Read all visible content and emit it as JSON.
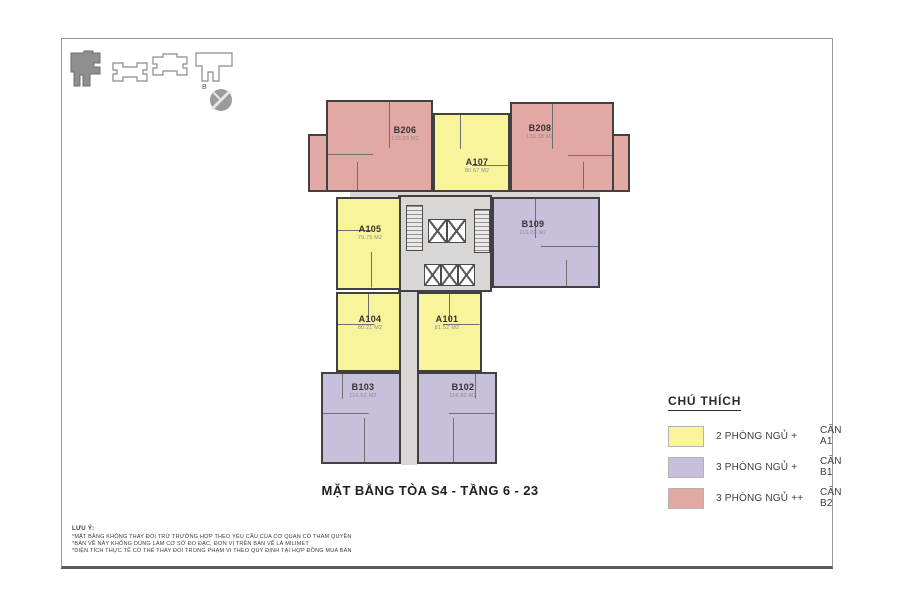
{
  "title": "MẶT BẰNG TÒA S4 - TẦNG 6 - 23",
  "keyplan": {
    "north_label": "B"
  },
  "colors": {
    "a1": "#f8f49c",
    "b1": "#c8bfdc",
    "b2": "#e2a8a4",
    "corridor": "#d9d7d6"
  },
  "units": [
    {
      "id": "B206",
      "area": "133.29 M2",
      "type": "B2"
    },
    {
      "id": "A107",
      "area": "80.67 M2",
      "type": "A1"
    },
    {
      "id": "B208",
      "area": "133.38 M2",
      "type": "B2"
    },
    {
      "id": "A105",
      "area": "79.75 M2",
      "type": "A1"
    },
    {
      "id": "B109",
      "area": "116.03 M2",
      "type": "B1"
    },
    {
      "id": "A104",
      "area": "80.21 M2",
      "type": "A1"
    },
    {
      "id": "A101",
      "area": "81.52 M2",
      "type": "A1"
    },
    {
      "id": "B103",
      "area": "116.62 M2",
      "type": "B1"
    },
    {
      "id": "B102",
      "area": "116.82 M2",
      "type": "B1"
    }
  ],
  "legend": {
    "heading": "CHÚ THÍCH",
    "items": [
      {
        "bedrooms": "2 PHÒNG NGỦ +",
        "unit": "CĂN A1",
        "color": "#f8f49c"
      },
      {
        "bedrooms": "3 PHÒNG NGỦ +",
        "unit": "CĂN B1",
        "color": "#c8bfdc"
      },
      {
        "bedrooms": "3 PHÒNG NGỦ ++",
        "unit": "CĂN B2",
        "color": "#e2a8a4"
      }
    ]
  },
  "notes": {
    "heading": "LƯU Ý:",
    "lines": [
      "*MẶT BẰNG KHÔNG THAY ĐỔI TRỪ TRƯỜNG HỢP THEO YÊU CẦU CỦA CƠ QUAN CÓ THẨM QUYỀN",
      "*BẢN VẼ NÀY KHÔNG DÙNG LÀM CƠ SỞ ĐO ĐẠC, ĐƠN VỊ TRÊN BẢN VẼ LÀ MILIMET",
      "*DIỆN TÍCH THỰC TẾ CÓ THỂ THAY ĐỔI TRONG PHẠM VI THEO QUY ĐỊNH TẠI HỢP ĐỒNG MUA BÁN"
    ]
  }
}
